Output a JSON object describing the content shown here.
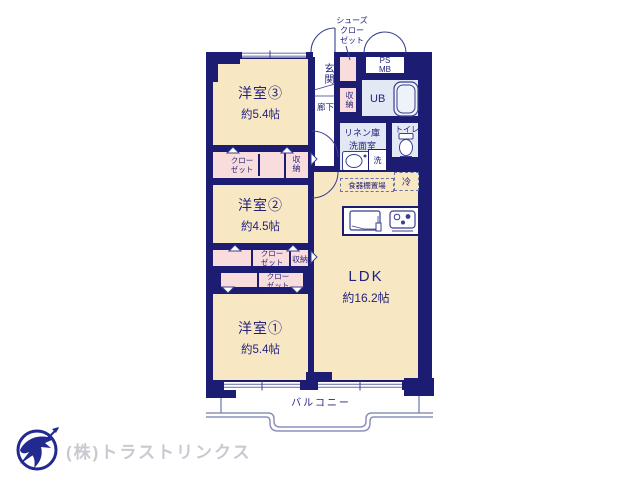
{
  "rooms": {
    "bedroom3": {
      "name": "洋室③",
      "size": "約5.4帖"
    },
    "bedroom2": {
      "name": "洋室②",
      "size": "約4.5帖"
    },
    "bedroom1": {
      "name": "洋室①",
      "size": "約5.4帖"
    },
    "ldk": {
      "name": "LDK",
      "size": "約16.2帖"
    }
  },
  "labels": {
    "entrance": "玄関",
    "hallway": "廊下",
    "shoe_closet": [
      "シューズ",
      "クロー",
      "ゼット"
    ],
    "closet": [
      "クロー",
      "ゼット"
    ],
    "storage": "収納",
    "ps": "PS",
    "mb": "MB",
    "unit_bath": "UB",
    "linen": "リネン庫",
    "washroom": "洗面室",
    "toilet": "トイレ",
    "washer": "洗",
    "cupboard": "食器棚置場",
    "fridge": "冷",
    "balcony": "バルコニー"
  },
  "footer": {
    "company": "(株)トラストリンクス"
  },
  "colors": {
    "wall": "#1c1c72",
    "room_fill": "#f7e7c3",
    "closet_fill": "#f9dddd",
    "wet_fill": "#e3e9f4",
    "text": "#23237d",
    "railing": "#8b90bd",
    "footer_text": "#c9c9d2",
    "logo": "#232a8f"
  }
}
